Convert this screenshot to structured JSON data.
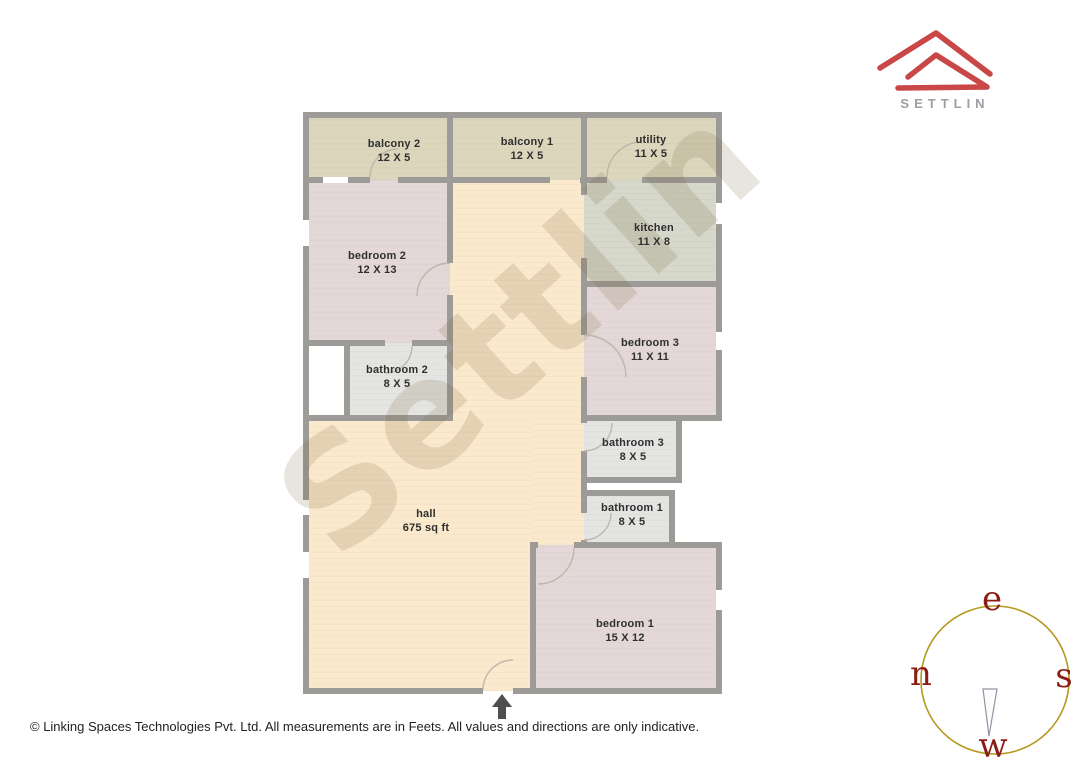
{
  "logo": {
    "brand": "SETTLIN"
  },
  "watermark": {
    "text": "Settlin"
  },
  "rooms": [
    {
      "name": "balcony 2",
      "dims": "12 X 5"
    },
    {
      "name": "balcony 1",
      "dims": "12 X 5"
    },
    {
      "name": "utility",
      "dims": "11 X 5"
    },
    {
      "name": "bedroom 2",
      "dims": "12 X 13"
    },
    {
      "name": "kitchen",
      "dims": "11 X 8"
    },
    {
      "name": "bedroom 3",
      "dims": "11 X 11"
    },
    {
      "name": "bathroom 2",
      "dims": "8 X 5"
    },
    {
      "name": "bathroom 3",
      "dims": "8 X 5"
    },
    {
      "name": "bathroom 1",
      "dims": "8 X 5"
    },
    {
      "name": "hall",
      "dims": "675 sq ft"
    },
    {
      "name": "bedroom 1",
      "dims": "15 X 12"
    }
  ],
  "compass": {
    "east": "e",
    "north": "n",
    "south": "s",
    "west": "w"
  },
  "footer": {
    "text": "© Linking Spaces Technologies Pvt. Ltd. All measurements are in Feets. All values and directions are only indicative."
  },
  "colors": {
    "balcony": "#dcd6bd",
    "hall": "#fae9cc",
    "bedroom": "#e3d8d7",
    "kitchen": "#d5d8ca",
    "bathroom": "#e4e4e2",
    "wall": "#9d9b97",
    "logo_red": "#c94747",
    "logo_text": "#9aa0a6",
    "compass_ring": "#b5981f",
    "compass_letters": "#8b1e14",
    "arrow": "#4f4f4f"
  }
}
